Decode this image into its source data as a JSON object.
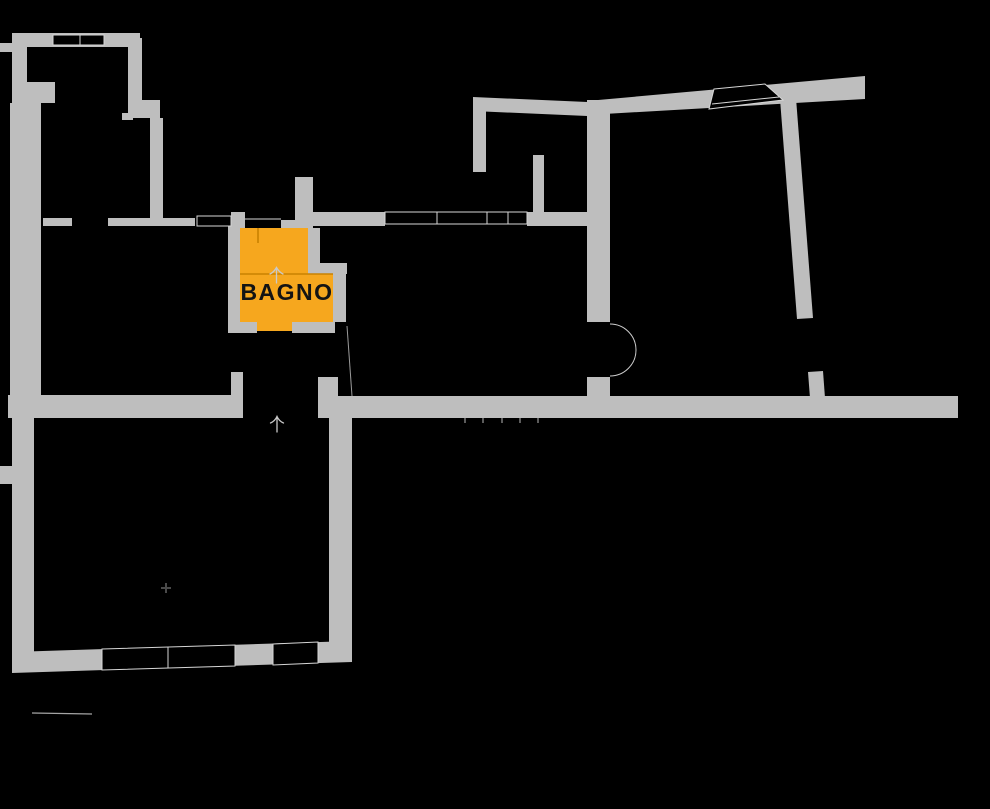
{
  "floorplan": {
    "title": "apartment-floor-plan",
    "rooms": [
      {
        "id": "bagno",
        "label": "BAGNO",
        "highlight_color": "#F6A71E",
        "label_color": "#141414",
        "selected": true
      }
    ],
    "colors": {
      "background": "#000000",
      "wall": "#BEBEBE",
      "opening": "#D6D6D6",
      "arc": "#CFCFCF",
      "arrow": "#C9C9C9",
      "divider": "#C98200",
      "symbol": "#4A4A4A",
      "hairline": "#A5A5A5"
    },
    "symbols": [
      {
        "name": "up-arrow-bagno-icon",
        "meaning": "door/step direction marker"
      },
      {
        "name": "up-arrow-entrance-icon",
        "meaning": "entrance direction marker"
      },
      {
        "name": "cross-marker-icon",
        "meaning": "survey point marker"
      }
    ]
  }
}
